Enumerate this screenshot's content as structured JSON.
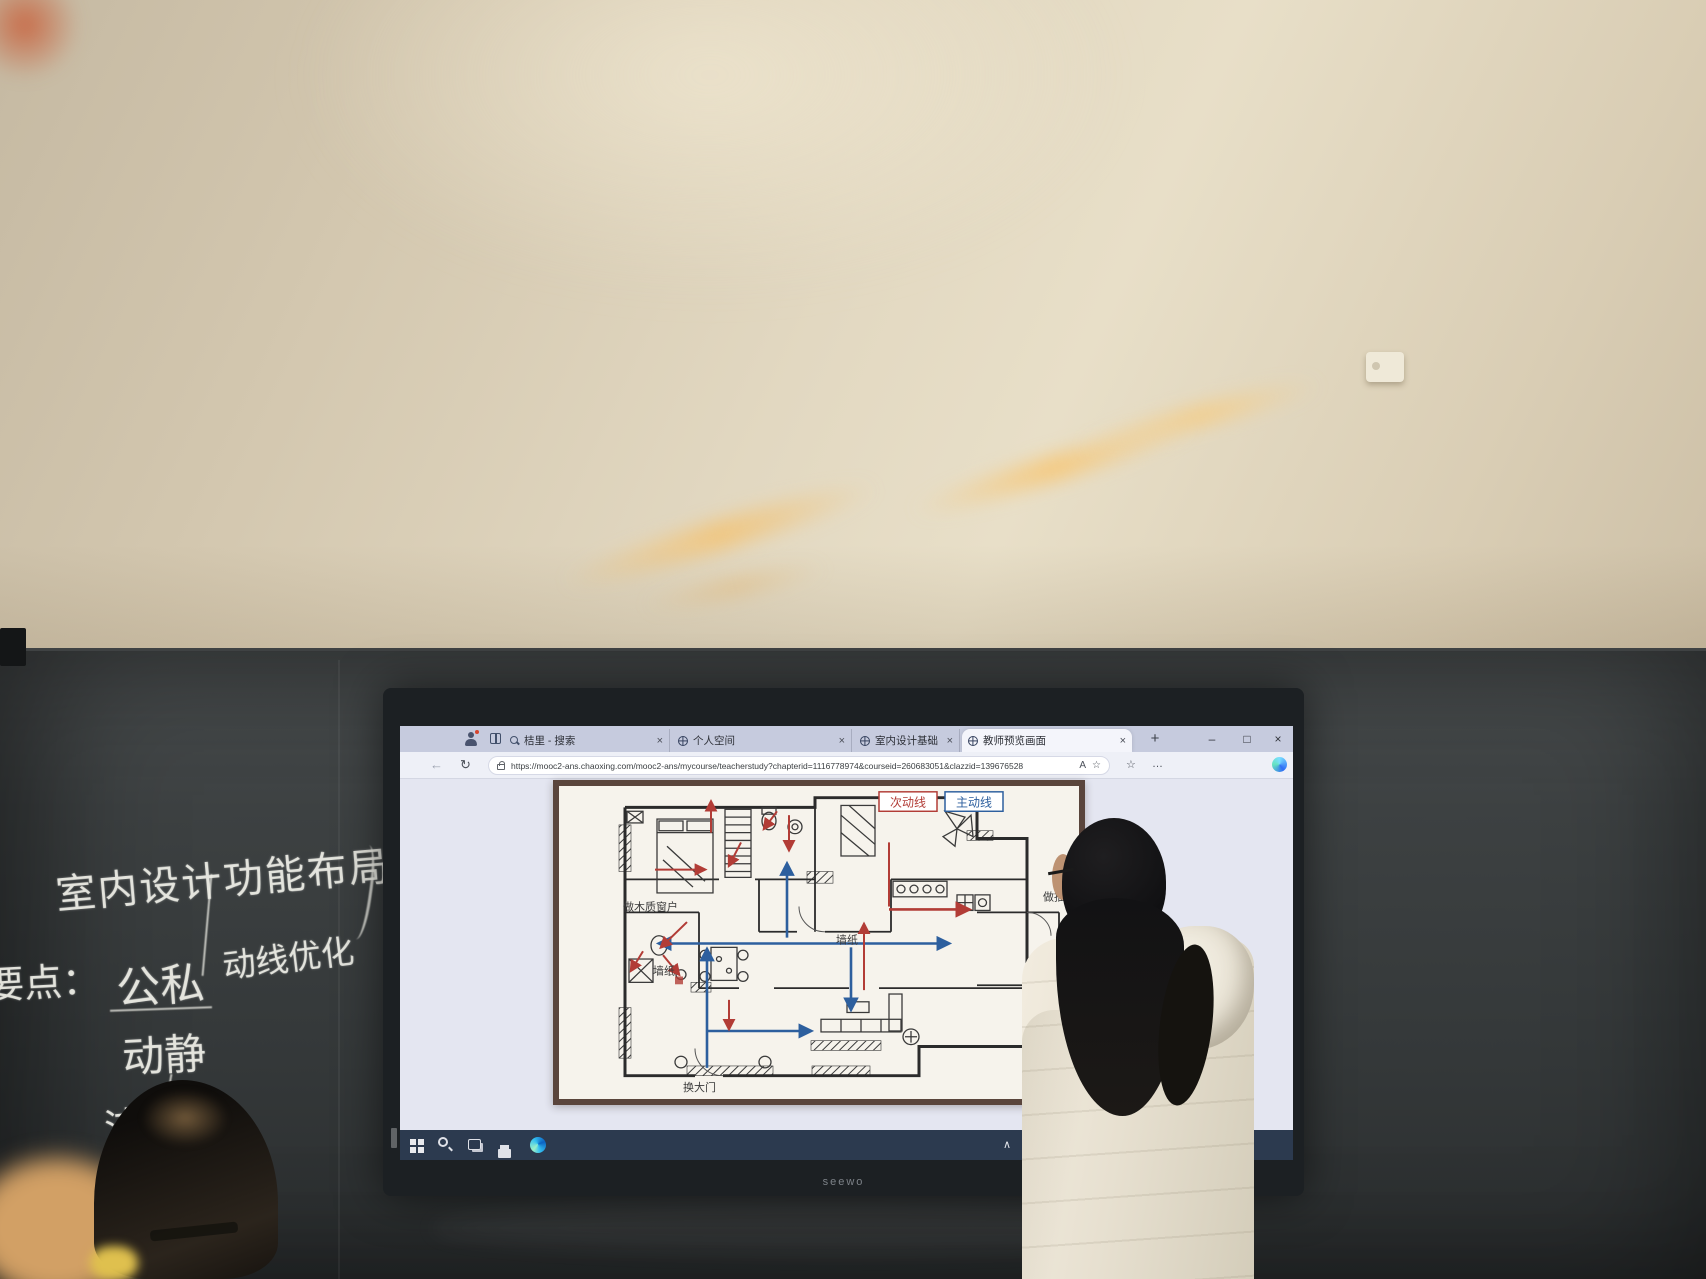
{
  "blackboard": {
    "title": "室内设计功能布局",
    "subtitle": "动线优化",
    "points_heading": "要点：",
    "points": [
      "公私",
      "动静",
      "洁污"
    ]
  },
  "browser": {
    "tabs": [
      {
        "title": "桔里 - 搜索",
        "icon": "search-icon"
      },
      {
        "title": "个人空间",
        "icon": "globe-icon"
      },
      {
        "title": "室内设计基础",
        "icon": "globe-icon"
      },
      {
        "title": "教师预览画面",
        "icon": "globe-icon"
      }
    ],
    "url": "https://mooc2-ans.chaoxing.com/mooc2-ans/mycourse/teacherstudy?chapterid=1116778974&courseid=260683051&clazzid=139676528",
    "glyphs": {
      "new_tab": "+",
      "close": "×",
      "minimize": "–",
      "maximize": "□",
      "back": "←",
      "refresh": "↻",
      "read_aloud": "A",
      "favorite": "☆",
      "collections": "☆",
      "more": "…"
    }
  },
  "slide": {
    "legend": [
      {
        "label": "次动线",
        "color": "#b23c36"
      },
      {
        "label": "主动线",
        "color": "#2d5f9e"
      }
    ],
    "labels": {
      "window": "做木质窗户",
      "wallpaper_left": "墙纸",
      "wallpaper_right": "墙纸",
      "drawer": "做抽屉",
      "door": "换大门"
    }
  },
  "taskbar": {
    "tray_chevron": "∧"
  },
  "monitor": {
    "brand": "seewo"
  },
  "colors": {
    "secondary_route": "#b23c36",
    "main_route": "#2d5f9e",
    "taskbar": "#2c3a4f",
    "slide_frame": "#5a453c"
  }
}
